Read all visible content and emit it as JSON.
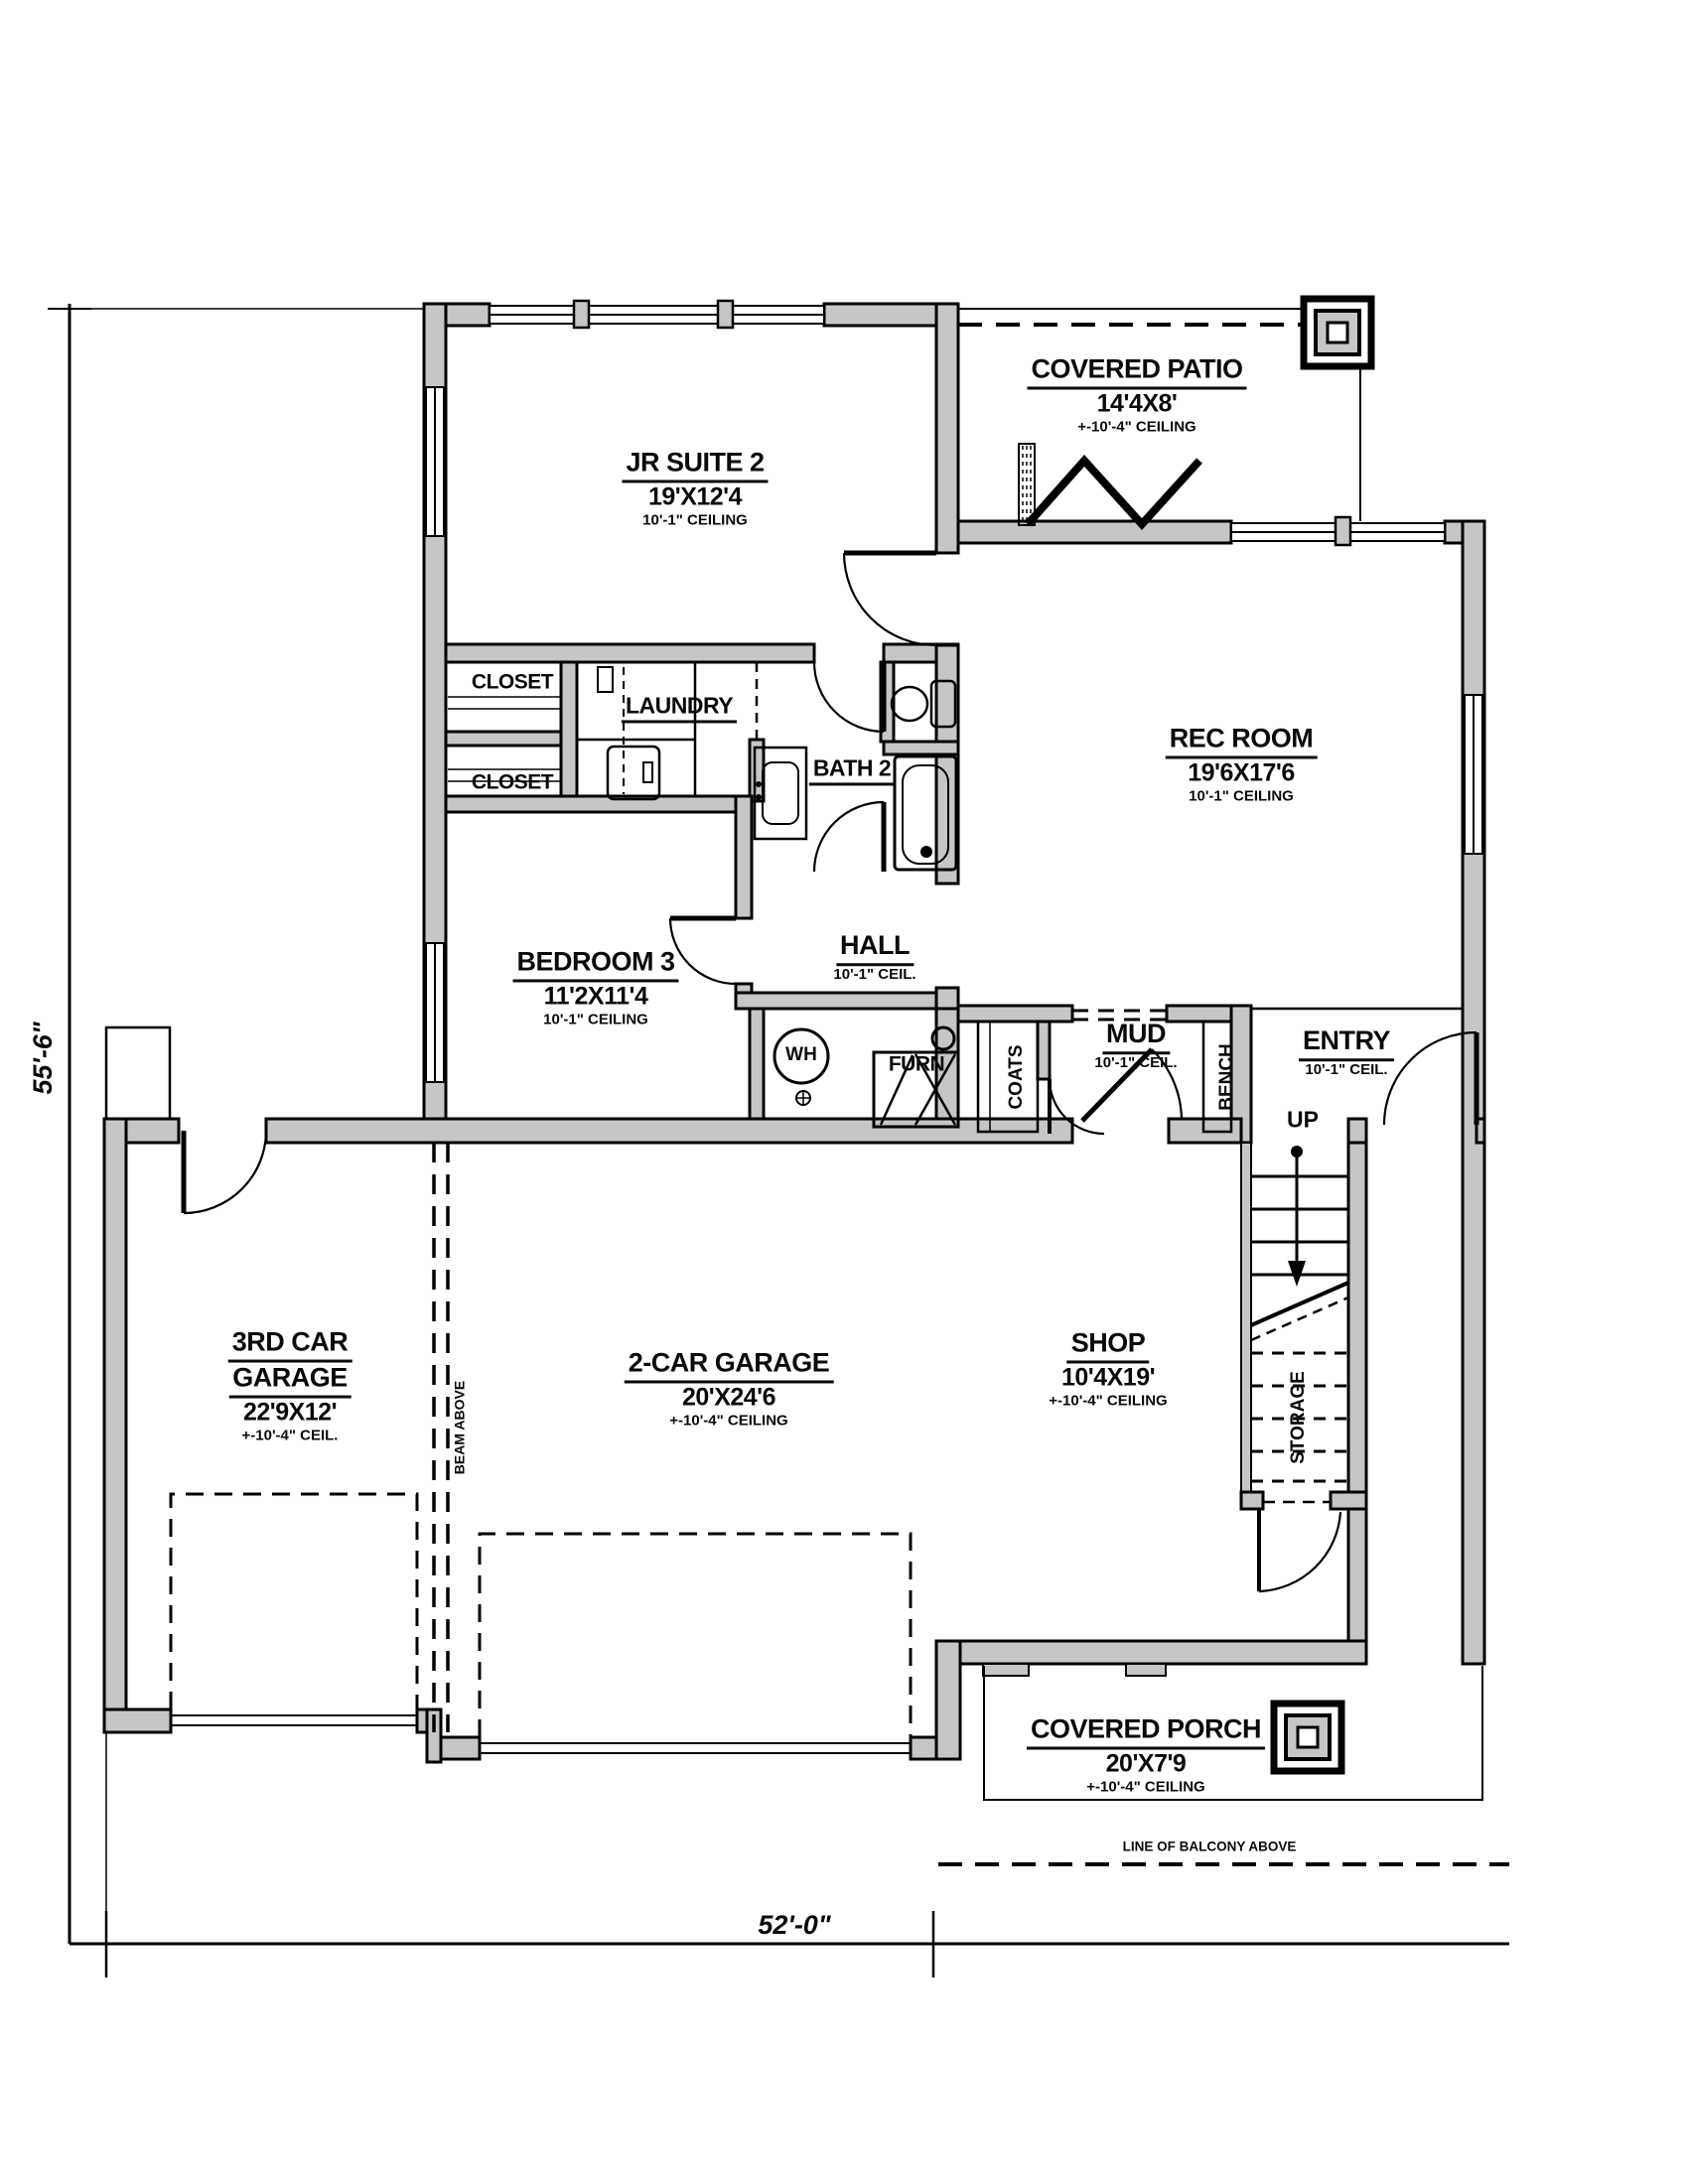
{
  "title": "First floor plan",
  "rooms": {
    "jr_suite": {
      "name": "JR SUITE 2",
      "size": "19'X12'4",
      "ceil": "10'-1\" CEILING"
    },
    "covered_patio": {
      "name": "COVERED PATIO",
      "size": "14'4X8'",
      "ceil": "+-10'-4\" CEILING"
    },
    "rec_room": {
      "name": "REC ROOM",
      "size": "19'6X17'6",
      "ceil": "10'-1\" CEILING"
    },
    "closet_upper": {
      "name": "CLOSET"
    },
    "closet_lower": {
      "name": "CLOSET"
    },
    "laundry": {
      "name": "LAUNDRY"
    },
    "bath2": {
      "name": "BATH 2"
    },
    "bedroom3": {
      "name": "BEDROOM 3",
      "size": "11'2X11'4",
      "ceil": "10'-1\" CEILING"
    },
    "hall": {
      "name": "HALL",
      "ceil": "10'-1\" CEIL."
    },
    "mud": {
      "name": "MUD",
      "ceil": "10'-1\" CEIL."
    },
    "entry": {
      "name": "ENTRY",
      "ceil": "10'-1\" CEIL."
    },
    "coats": {
      "name": "COATS"
    },
    "bench": {
      "name": "BENCH"
    },
    "storage": {
      "name": "STORAGE"
    },
    "wh": {
      "name": "WH"
    },
    "furn": {
      "name": "FURN"
    },
    "garage_3rd": {
      "name1": "3RD CAR",
      "name2": "GARAGE",
      "size": "22'9X12'",
      "ceil": "+-10'-4\" CEIL."
    },
    "garage_2car": {
      "name": "2-CAR GARAGE",
      "size": "20'X24'6",
      "ceil": "+-10'-4\" CEILING"
    },
    "shop": {
      "name": "SHOP",
      "size": "10'4X19'",
      "ceil": "+-10'-4\" CEILING"
    },
    "covered_porch": {
      "name": "COVERED PORCH",
      "size": "20'X7'9",
      "ceil": "+-10'-4\" CEILING"
    }
  },
  "annotations": {
    "up": "UP",
    "beam": "BEAM ABOVE",
    "balcony": "LINE OF BALCONY ABOVE"
  },
  "dimensions": {
    "overall_width": "52'-0\"",
    "overall_height": "55'-6\""
  },
  "colors": {
    "wall_fill": "#c6c6c6",
    "line": "#000000"
  }
}
